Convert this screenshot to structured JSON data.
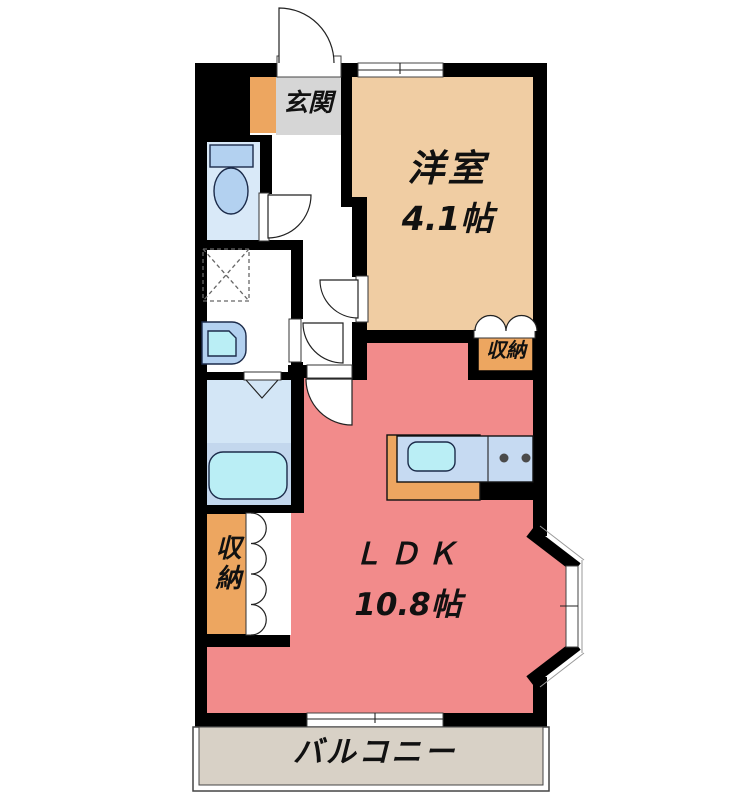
{
  "title": "apartment-floor-plan",
  "palette": {
    "wall": "#000000",
    "western_room_floor": "#f0cda3",
    "ldk_floor": "#f28b8b",
    "genkan_floor": "#d6d6d6",
    "accent_orange": "#eda660",
    "toilet_floor": "#d9e9f8",
    "bathroom_floor": "#d3e6f6",
    "tub_surround": "#c3d7ed",
    "fixture_blue": "#b3d1f0",
    "cyan_fixture": "#baeef5",
    "kitchen_counter_top": "#c6daf2",
    "balcony_floor": "#d8d1c6",
    "text": "#111111"
  },
  "rooms": {
    "genkan": {
      "label": "玄関"
    },
    "western_room": {
      "label": "洋室",
      "size": "4.1帖"
    },
    "ldk": {
      "label": "ＬＤＫ",
      "size": "10.8帖"
    },
    "storage_west": {
      "label": "収納"
    },
    "storage_ldk": {
      "label": "収納"
    },
    "balcony": {
      "label": "バルコニー"
    }
  },
  "fixtures": [
    "entrance-door",
    "toilet",
    "washing-machine-pan",
    "washbasin",
    "bathtub",
    "folding-bath-door",
    "closet-folding-door",
    "kitchen-sink",
    "gas-stove",
    "bay-window",
    "sliding-window",
    "top-window"
  ]
}
